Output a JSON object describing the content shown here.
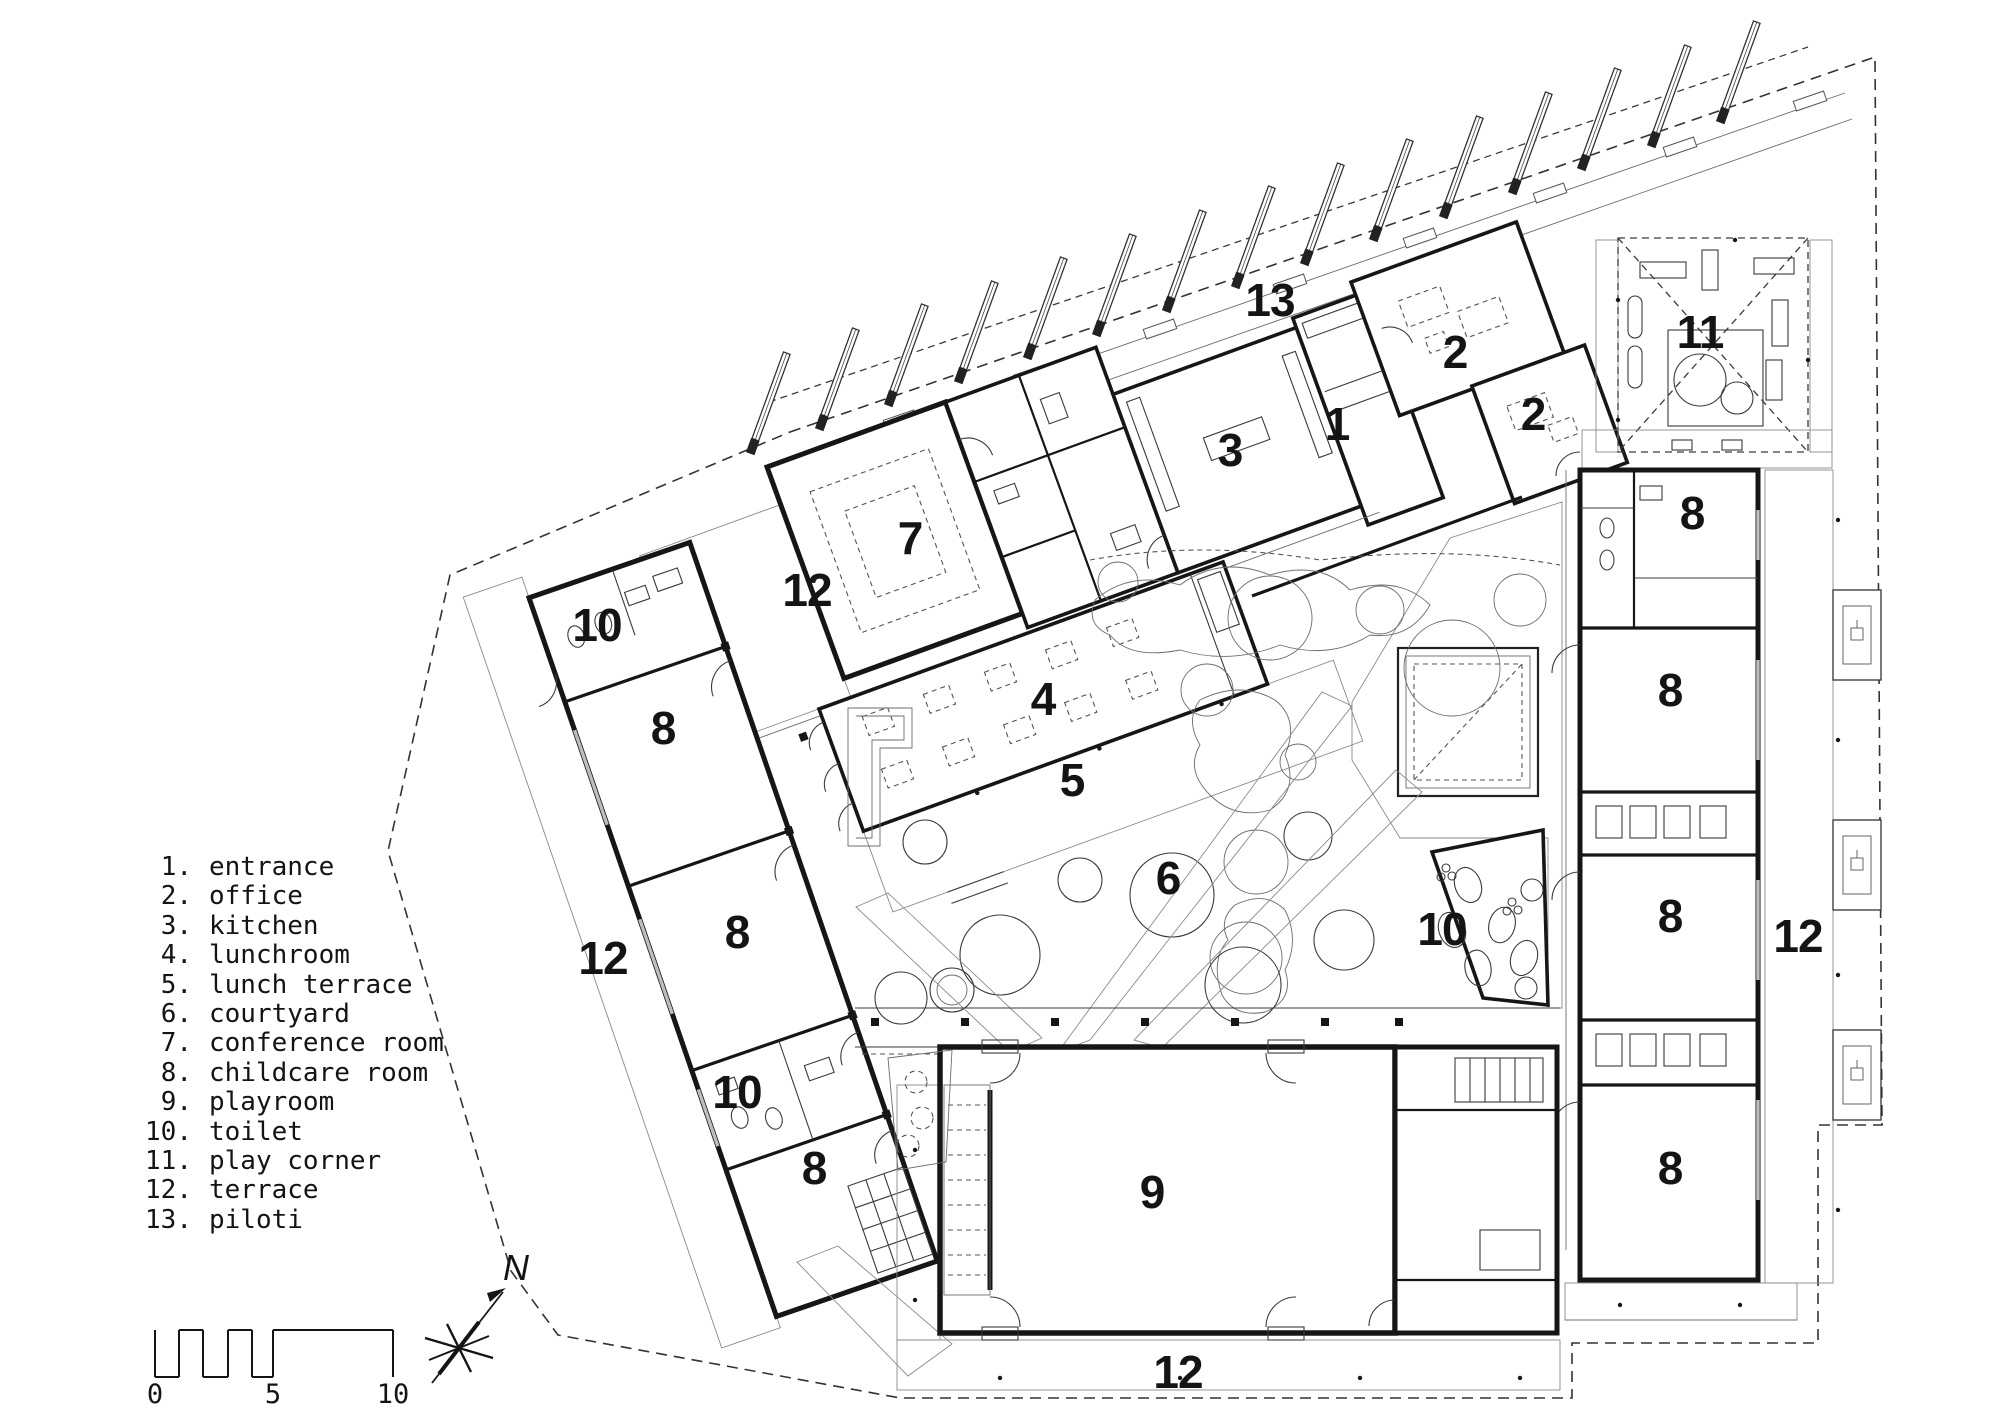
{
  "figure_type": "architectural-floor-plan",
  "colors": {
    "ink": "#161616",
    "thin_line": "#3a3a3a",
    "hatch": "#909090",
    "background": "#ffffff"
  },
  "legend": {
    "items": [
      {
        "num": "1.",
        "label": "entrance"
      },
      {
        "num": "2.",
        "label": "office"
      },
      {
        "num": "3.",
        "label": "kitchen"
      },
      {
        "num": "4.",
        "label": "lunchroom"
      },
      {
        "num": "5.",
        "label": "lunch terrace"
      },
      {
        "num": "6.",
        "label": "courtyard"
      },
      {
        "num": "7.",
        "label": "conference room"
      },
      {
        "num": "8.",
        "label": "childcare room"
      },
      {
        "num": "9.",
        "label": "playroom"
      },
      {
        "num": "10.",
        "label": "toilet"
      },
      {
        "num": "11.",
        "label": "play corner"
      },
      {
        "num": "12.",
        "label": "terrace"
      },
      {
        "num": "13.",
        "label": "piloti"
      }
    ]
  },
  "plan": {
    "room_labels": [
      {
        "text": "13",
        "x": 1270,
        "y": 300
      },
      {
        "text": "11",
        "x": 1700,
        "y": 332
      },
      {
        "text": "2",
        "x": 1455,
        "y": 352
      },
      {
        "text": "2",
        "x": 1533,
        "y": 414
      },
      {
        "text": "1",
        "x": 1337,
        "y": 424
      },
      {
        "text": "3",
        "x": 1230,
        "y": 450
      },
      {
        "text": "7",
        "x": 910,
        "y": 538
      },
      {
        "text": "12",
        "x": 807,
        "y": 590
      },
      {
        "text": "10",
        "x": 597,
        "y": 625
      },
      {
        "text": "8",
        "x": 663,
        "y": 728
      },
      {
        "text": "4",
        "x": 1043,
        "y": 699
      },
      {
        "text": "5",
        "x": 1072,
        "y": 780
      },
      {
        "text": "8",
        "x": 1692,
        "y": 513
      },
      {
        "text": "8",
        "x": 1670,
        "y": 690
      },
      {
        "text": "6",
        "x": 1168,
        "y": 878
      },
      {
        "text": "8",
        "x": 737,
        "y": 932
      },
      {
        "text": "12",
        "x": 603,
        "y": 958
      },
      {
        "text": "10",
        "x": 1442,
        "y": 929
      },
      {
        "text": "8",
        "x": 1670,
        "y": 916
      },
      {
        "text": "12",
        "x": 1798,
        "y": 936
      },
      {
        "text": "10",
        "x": 737,
        "y": 1092
      },
      {
        "text": "8",
        "x": 814,
        "y": 1168
      },
      {
        "text": "8",
        "x": 1670,
        "y": 1168
      },
      {
        "text": "9",
        "x": 1152,
        "y": 1192
      },
      {
        "text": "12",
        "x": 1178,
        "y": 1372
      }
    ]
  },
  "scale_bar": {
    "ticks": [
      {
        "label": "0",
        "x": 155
      },
      {
        "label": "5",
        "x": 273
      },
      {
        "label": "10",
        "x": 393
      }
    ]
  },
  "north": {
    "label": "N"
  }
}
